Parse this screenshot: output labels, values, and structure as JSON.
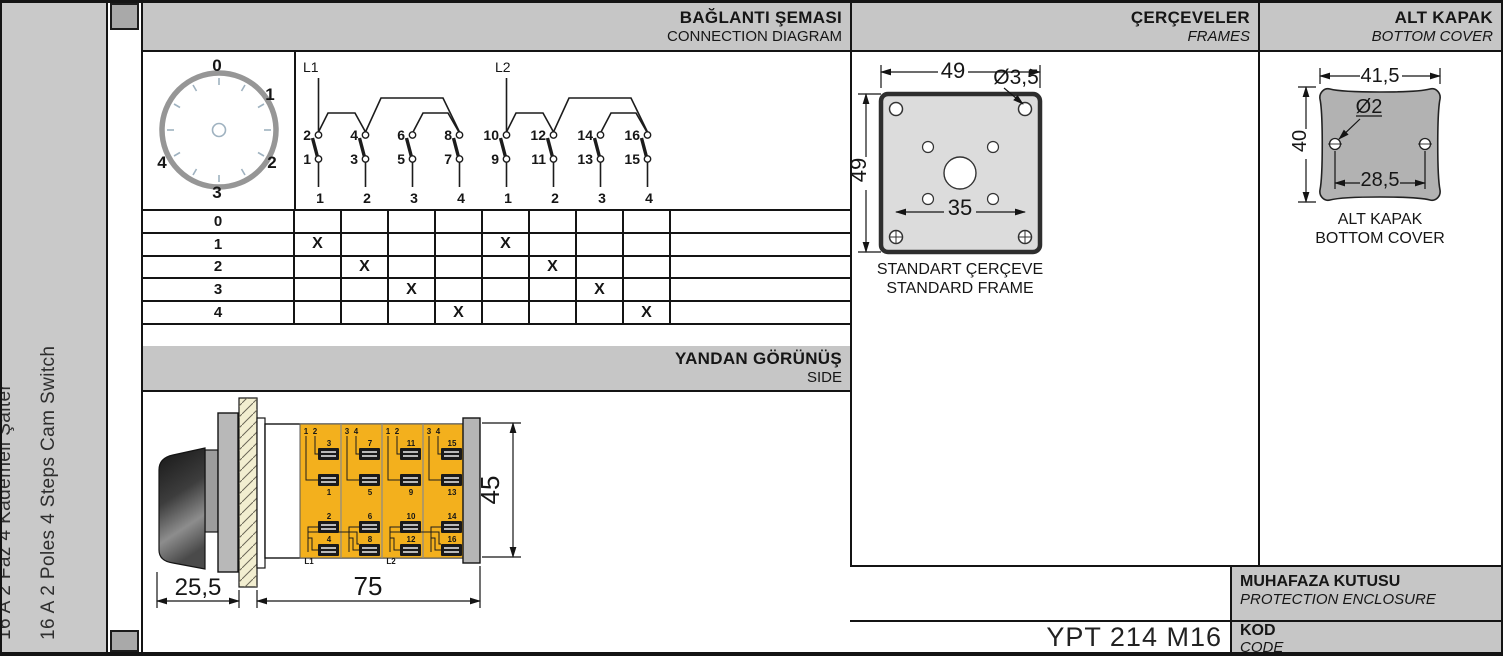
{
  "sidebar": {
    "title_tr": "16 A 2 Faz 4 Kademeli Şalter",
    "title_en": "16 A 2 Poles 4 Steps Cam Switch"
  },
  "sections": {
    "connection": {
      "title_tr": "BAĞLANTI ŞEMASI",
      "title_en": "CONNECTION DIAGRAM"
    },
    "side": {
      "title_tr": "YANDAN GÖRÜNÜŞ",
      "title_en": "SIDE"
    },
    "frames": {
      "title_tr": "ÇERÇEVELER",
      "title_en": "FRAMES"
    },
    "cover": {
      "title_tr": "ALT KAPAK",
      "title_en": "BOTTOM COVER"
    }
  },
  "dial": {
    "labels": [
      "0",
      "1",
      "2",
      "3",
      "4"
    ]
  },
  "schematic": {
    "feeds": [
      "L1",
      "L2"
    ],
    "switches": [
      {
        "top": "2",
        "bottom": "1",
        "pos": "1"
      },
      {
        "top": "4",
        "bottom": "3",
        "pos": "2"
      },
      {
        "top": "6",
        "bottom": "5",
        "pos": "3"
      },
      {
        "top": "8",
        "bottom": "7",
        "pos": "4"
      },
      {
        "top": "10",
        "bottom": "9",
        "pos": "1"
      },
      {
        "top": "12",
        "bottom": "11",
        "pos": "2"
      },
      {
        "top": "14",
        "bottom": "13",
        "pos": "3"
      },
      {
        "top": "16",
        "bottom": "15",
        "pos": "4"
      }
    ]
  },
  "switch_table": {
    "rows": [
      {
        "label": "0",
        "cells": [
          "",
          "",
          "",
          "",
          "",
          "",
          "",
          ""
        ]
      },
      {
        "label": "1",
        "cells": [
          "X",
          "",
          "",
          "",
          "X",
          "",
          "",
          ""
        ]
      },
      {
        "label": "2",
        "cells": [
          "",
          "X",
          "",
          "",
          "",
          "X",
          "",
          ""
        ]
      },
      {
        "label": "3",
        "cells": [
          "",
          "",
          "X",
          "",
          "",
          "",
          "X",
          ""
        ]
      },
      {
        "label": "4",
        "cells": [
          "",
          "",
          "",
          "X",
          "",
          "",
          "",
          "X"
        ]
      }
    ]
  },
  "side_view": {
    "dims": {
      "knob_depth": "25,5",
      "body_length": "75",
      "body_height": "45"
    },
    "modules": [
      {
        "steps": [
          "1",
          "2"
        ],
        "upper": "3",
        "lower": "1",
        "bottom_upper": "2",
        "bottom_lower": "4",
        "feed": "L1"
      },
      {
        "steps": [
          "3",
          "4"
        ],
        "upper": "7",
        "lower": "5",
        "bottom_upper": "6",
        "bottom_lower": "8",
        "feed": ""
      },
      {
        "steps": [
          "1",
          "2"
        ],
        "upper": "11",
        "lower": "9",
        "bottom_upper": "10",
        "bottom_lower": "12",
        "feed": "L2"
      },
      {
        "steps": [
          "3",
          "4"
        ],
        "upper": "15",
        "lower": "13",
        "bottom_upper": "14",
        "bottom_lower": "16",
        "feed": ""
      }
    ]
  },
  "frame": {
    "dim_width": "49",
    "dim_height": "49",
    "dim_hole": "Ø3,5",
    "dim_inner": "35",
    "caption_tr": "STANDART ÇERÇEVE",
    "caption_en": "STANDARD FRAME"
  },
  "cover": {
    "dim_width": "41,5",
    "dim_height": "40",
    "dim_hole": "Ø2",
    "dim_span": "28,5",
    "caption_tr": "ALT KAPAK",
    "caption_en": "BOTTOM COVER"
  },
  "footer": {
    "enclosure_tr": "MUHAFAZA KUTUSU",
    "enclosure_en": "PROTECTION ENCLOSURE",
    "code_label_tr": "KOD",
    "code_label_en": "CODE",
    "code_value": "YPT 214 M16"
  },
  "colors": {
    "band_gray": "#c6c6c6",
    "module_yellow": "#f3b01d",
    "terminal_number": "#8ba0b0"
  }
}
